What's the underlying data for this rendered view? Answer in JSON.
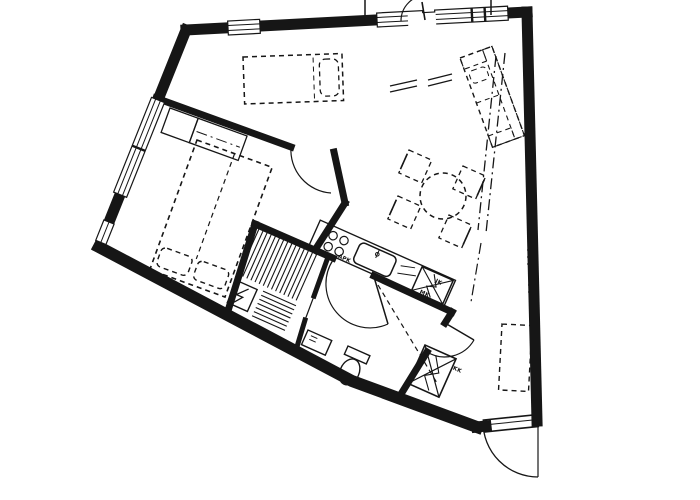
{
  "floor_plan": {
    "paper_color": "#ffffff",
    "ink_color": "#161616",
    "appliance_labels": {
      "dishwasher": "APK",
      "fridge": "JK",
      "freezer": "MK",
      "entry_cabinet": "KK"
    },
    "fixture_icons": [
      "double-bed-icon",
      "single-bed-icon",
      "wardrobe-icon",
      "sofa-icon",
      "dining-table-icon",
      "chair-icon",
      "stove-icon",
      "kitchen-sink-icon",
      "fridge-reservation-icon",
      "sauna-bench-icon",
      "sauna-heater-icon",
      "toilet-icon",
      "washbasin-icon",
      "entrance-door-icon",
      "balcony-door-icon",
      "window-icon",
      "wardrobe-reservation-icon"
    ]
  }
}
